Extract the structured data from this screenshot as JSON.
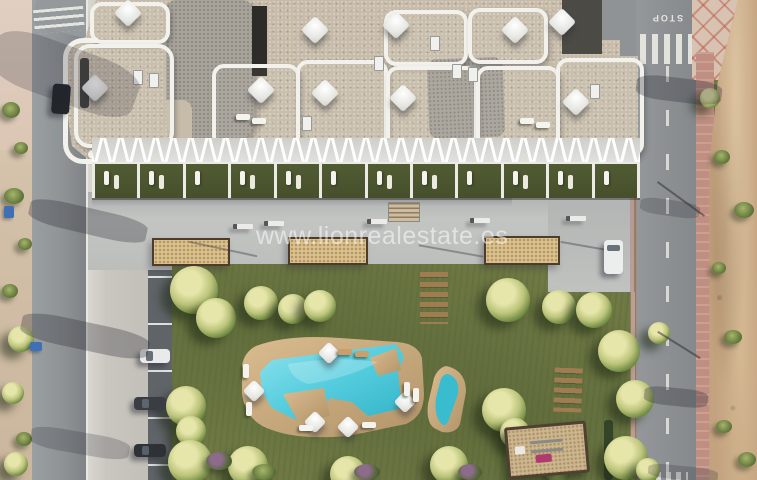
{
  "watermark": {
    "text": "www.lionrealestate.es"
  },
  "road": {
    "stop_marking": "STOP"
  },
  "palette": {
    "grass": "#6e7944",
    "stone": "#c7bca9",
    "roofgray": "#a7a39a",
    "planter": "#dcc28f",
    "dirt": "#c3a27f",
    "wood": "#a07c50",
    "poolwater": "#45c4d6",
    "poolwaterlight": "#8fe2ec",
    "decktan": "#cfae7f",
    "deckdark": "#b3946a"
  }
}
